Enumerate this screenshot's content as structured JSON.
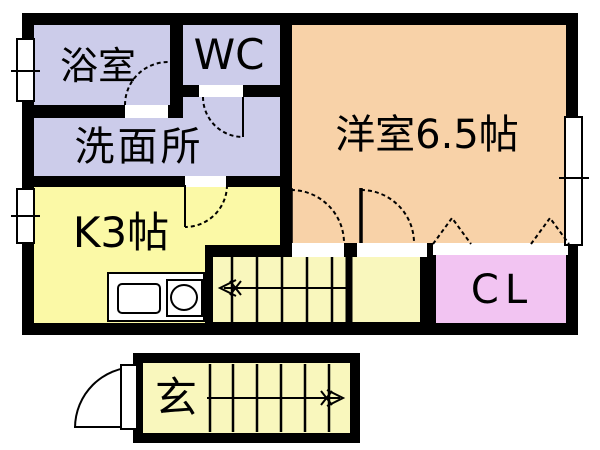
{
  "plan_type": "floor-plan",
  "rooms": {
    "bathroom": {
      "label": "浴室"
    },
    "wc": {
      "label": "WC"
    },
    "washroom": {
      "label": "洗面所"
    },
    "western_room": {
      "label": "洋室6.5帖"
    },
    "kitchen": {
      "label": "K3帖"
    },
    "closet": {
      "label": "CL"
    },
    "entrance": {
      "label": "玄"
    }
  },
  "colors": {
    "wall": "#000000",
    "wet_area": "#ccccea",
    "western_room": "#f8d2a8",
    "kitchen": "#fbf9a6",
    "stairwell": "#f9f7bd",
    "closet": "#f2c4f2",
    "opening": "#ffffff"
  },
  "icons": {
    "stairs_up_main": "left-arrow-icon",
    "stairs_up_entrance": "right-arrow-icon",
    "closet_doors": "folding-door-triangle-icon",
    "kitchen_fixtures": [
      "sink-icon",
      "burner-icon"
    ]
  }
}
